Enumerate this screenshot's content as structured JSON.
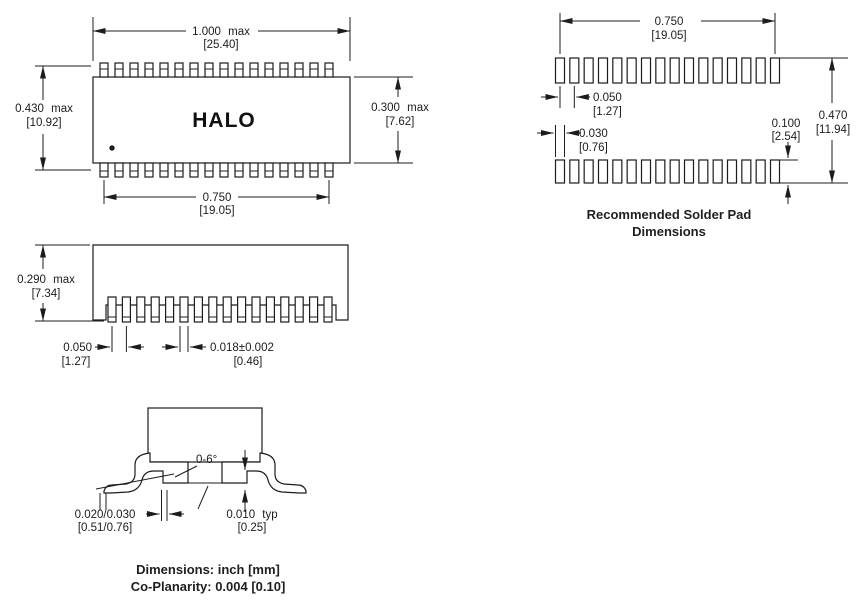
{
  "brand": "HALO",
  "top_view": {
    "pins_per_side": 16,
    "length_in": "1.000 max",
    "length_mm": "[25.40]",
    "height_in": "0.430 max",
    "height_mm": "[10.92]",
    "width_in": "0.300 max",
    "width_mm": "[7.62]",
    "span_in": "0.750",
    "span_mm": "[19.05]"
  },
  "pad_view": {
    "pads_per_row": 16,
    "caption1": "Recommended Solder Pad",
    "caption2": "Dimensions",
    "span_in": "0.750",
    "span_mm": "[19.05]",
    "pitch_in": "0.050",
    "pitch_mm": "[1.27]",
    "pad_w_in": "0.030",
    "pad_w_mm": "[0.76]",
    "pad_h_in": "0.100",
    "pad_h_mm": "[2.54]",
    "overall_in": "0.470",
    "overall_mm": "[11.94]"
  },
  "side_view": {
    "leads": 16,
    "height_in": "0.290 max",
    "height_mm": "[7.34]",
    "pitch_in": "0.050",
    "pitch_mm": "[1.27]",
    "lead_w_in": "0.018±0.002",
    "lead_w_mm": "[0.46]"
  },
  "end_view": {
    "angle": "0-6°",
    "foot_in": "0.020/0.030",
    "foot_mm": "[0.51/0.76]",
    "standoff_in": "0.010 typ",
    "standoff_mm": "[0.25]"
  },
  "notes": {
    "units": "Dimensions: inch [mm]",
    "coplanarity": "Co-Planarity: 0.004 [0.10]"
  }
}
